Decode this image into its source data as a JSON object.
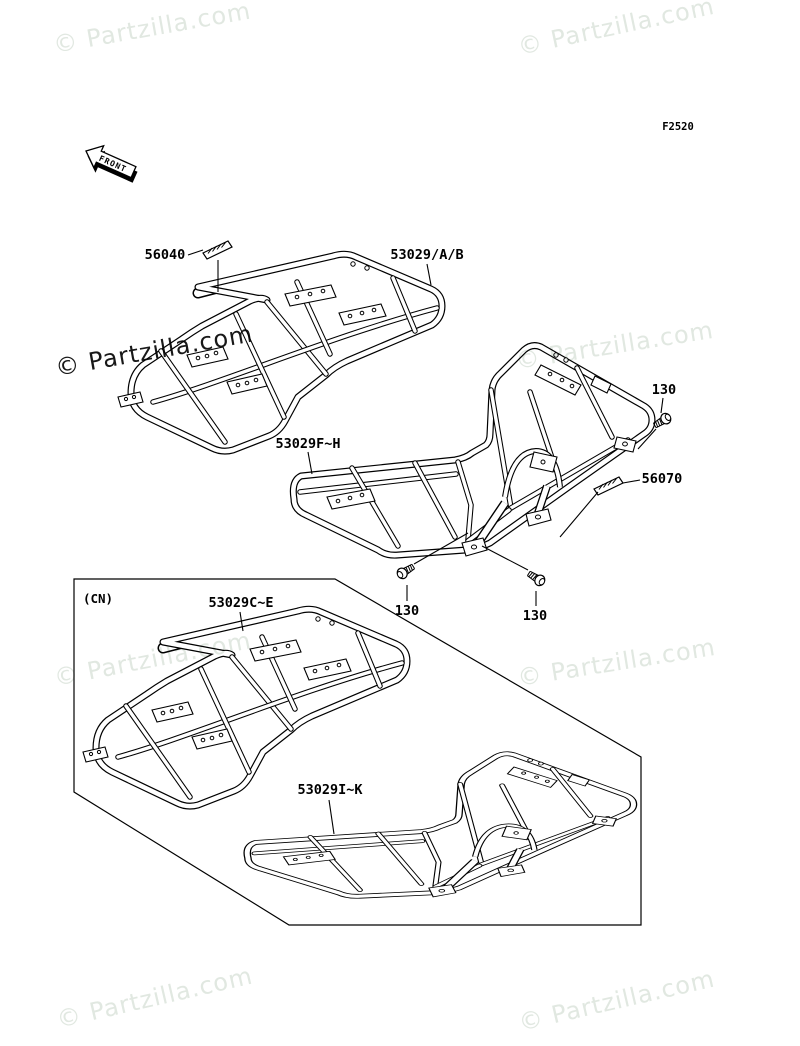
{
  "canvas": {
    "width": 800,
    "height": 1046,
    "background": "#ffffff",
    "line_color": "#000000"
  },
  "watermark": {
    "text": "© Partzilla.com",
    "light_color": "#e1e8e1",
    "dark_color": "#181818"
  },
  "header": {
    "fiche_code": "F2520",
    "front_arrow": "FRONT"
  },
  "variant_box": {
    "label": "(CN)"
  },
  "labels": {
    "p56040": "56040",
    "p53029ab": "53029/A/B",
    "p53029fh": "53029F~H",
    "p130_top": "130",
    "p56070": "56070",
    "p53029ce": "53029C~E",
    "p53029ik": "53029I~K",
    "p130_left": "130",
    "p130_right": "130"
  }
}
